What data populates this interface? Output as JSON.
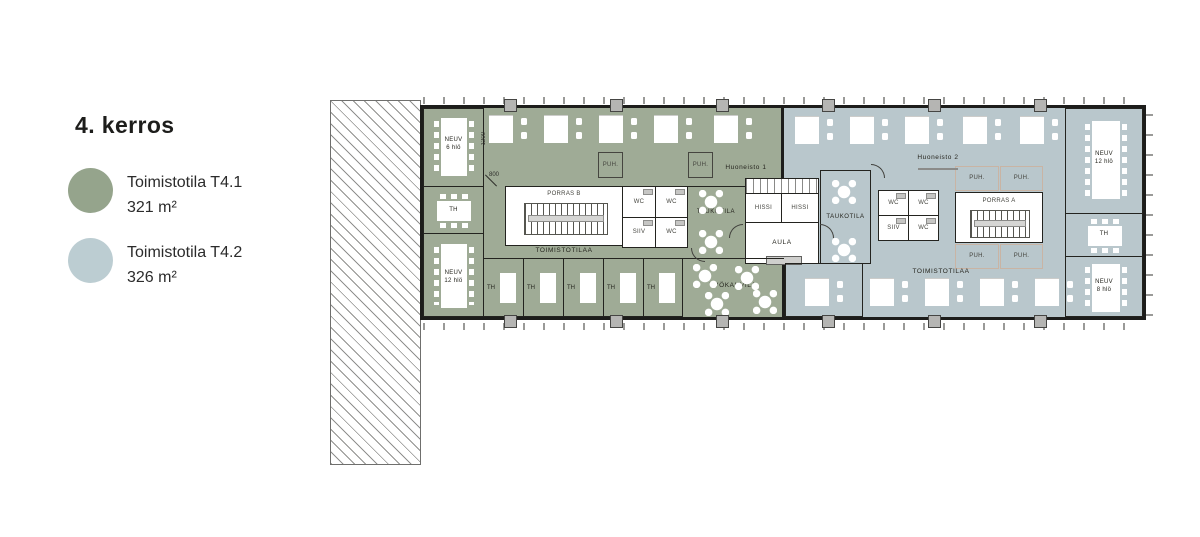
{
  "header": {
    "title": "4. kerros"
  },
  "legend": {
    "items": [
      {
        "id": "t41",
        "label": "Toimistotila T4.1",
        "area": "321 m²",
        "color": "#95a48c"
      },
      {
        "id": "t42",
        "label": "Toimistotila T4.2",
        "area": "326 m²",
        "color": "#bccdd2"
      }
    ]
  },
  "floorplan": {
    "colors": {
      "office_t41": "#9fab96",
      "office_t42": "#b9c7cc",
      "wall": "#1d1d1b",
      "core": "#ffffff"
    },
    "units": {
      "unit1": "Huoneisto 1",
      "unit2": "Huoneisto 2"
    },
    "labels": {
      "neuv6": "NEUV\n6 hlö",
      "neuv12": "NEUV\n12 hlö",
      "neuv8": "NEUV\n8 hlö",
      "th": "TH",
      "wc": "WC",
      "siiv": "SIIV",
      "puh": "PUH.",
      "hissi": "HISSI",
      "aula": "AULA",
      "taukotila": "TAUKOTILA",
      "toimistotilaa": "TOIMISTOTILAA",
      "tyokahvila": "TYÖKAHVILA",
      "porras_a": "PORRAS A",
      "porras_b": "PORRAS B"
    },
    "dimensions": {
      "depth_mark": "1200",
      "width_mark": "800"
    }
  }
}
